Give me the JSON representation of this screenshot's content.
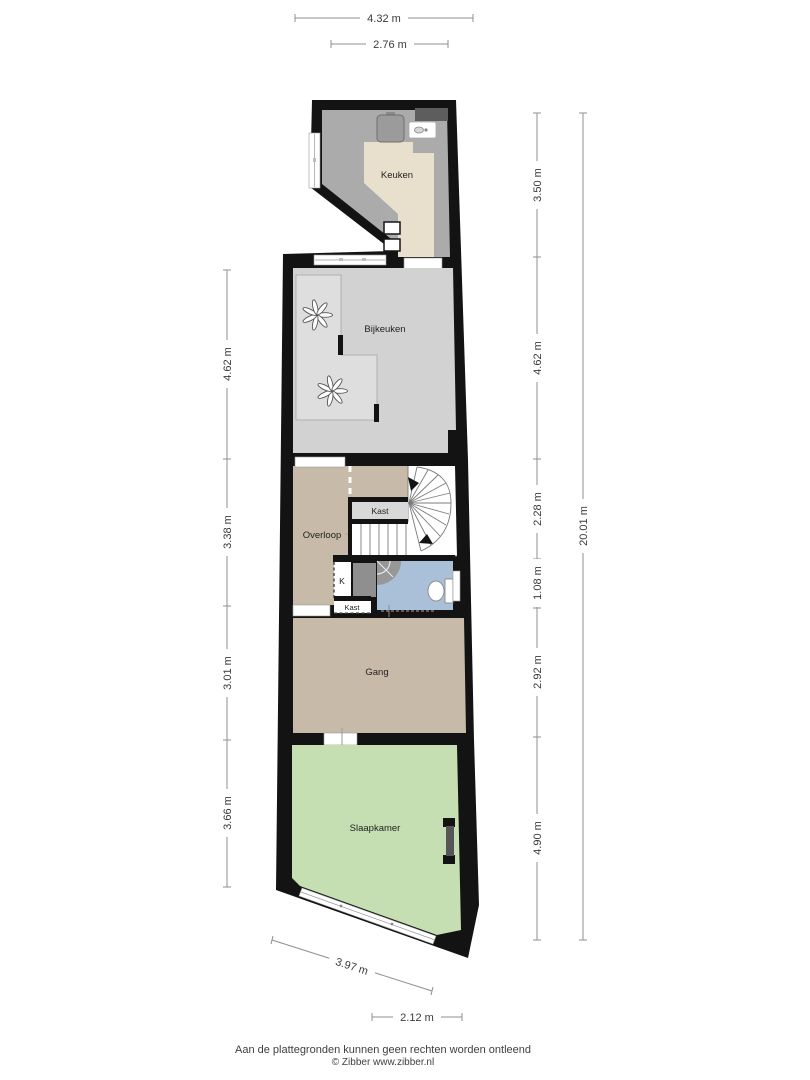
{
  "page": {
    "footer_line1": "Aan de plattegronden kunnen geen rechten worden ontleend",
    "footer_line2": "© Zibber www.zibber.nl"
  },
  "rooms": {
    "keuken": "Keuken",
    "bijkeuken": "Bijkeuken",
    "overloop": "Overloop",
    "kast_top": "Kast",
    "k": "K",
    "kast_bottom": "Kast",
    "gang": "Gang",
    "slaapkamer": "Slaapkamer"
  },
  "dims": {
    "top": [
      "4.32 m",
      "2.76 m"
    ],
    "left": [
      "4.62 m",
      "3.38 m",
      "3.01 m",
      "3.66 m"
    ],
    "right": [
      "3.50 m",
      "4.62 m",
      "2.28 m",
      "1.08 m",
      "2.92 m",
      "4.90 m"
    ],
    "right_total": "20.01 m",
    "bottom_diagonal": "3.97 m",
    "bottom": "2.12 m"
  },
  "icons": [
    "stove-icon",
    "sink-icon",
    "ventilation-fan-icon",
    "stairs-up-arrow-icon",
    "shower-icon",
    "toilet-icon",
    "window-glyph",
    "door-opening-glyph"
  ],
  "colors": {
    "walls": "#131313",
    "keuken_floor": "#e8e0cc",
    "keuken_counter": "#ababab",
    "bijkeuken": "#d2d2d2",
    "bijkeuken_inner": "#dedede",
    "overloop": "#c8baa9",
    "gang": "#c8baa9",
    "slaapkamer": "#c5dfb2",
    "bathroom": "#a9c0d8",
    "kast": "#d8d8d8",
    "appliance": "#9b9b9b",
    "dark_unit": "#5d5d5d",
    "utility_dark": "#8f8f8f",
    "door_dark": "#565656"
  }
}
